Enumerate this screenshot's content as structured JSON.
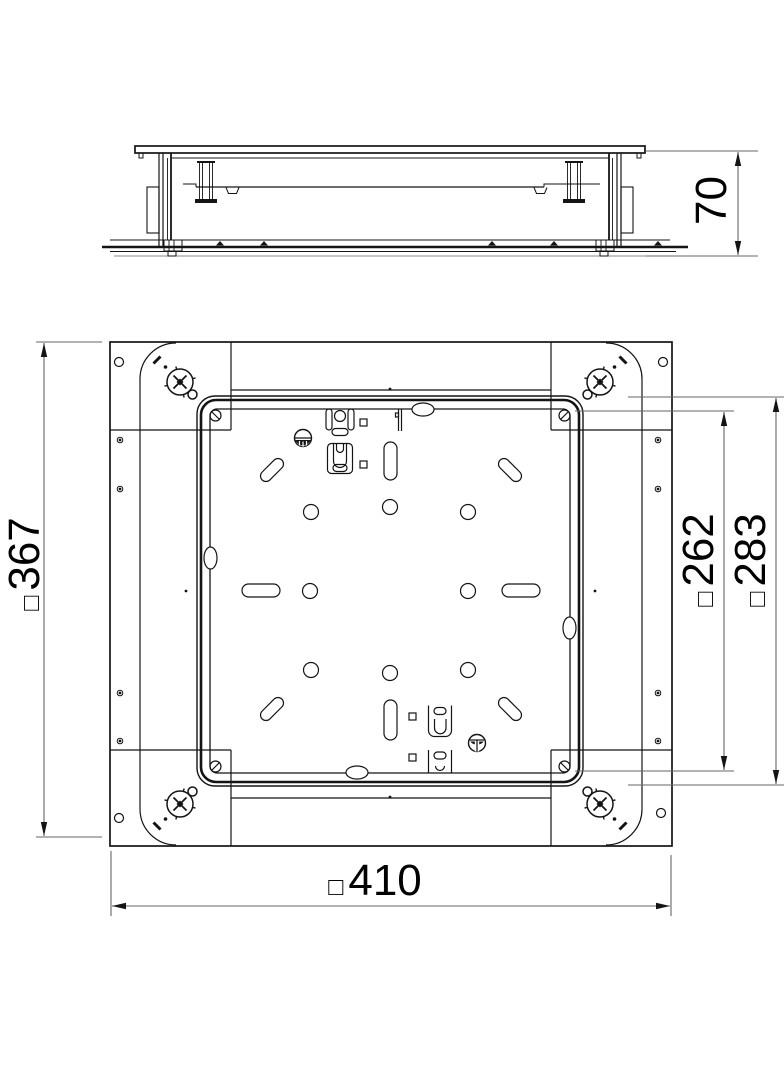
{
  "drawing": {
    "title": "underfloor-box-dimension-drawing",
    "dimensions": {
      "depth": {
        "prefix": "",
        "value": "70"
      },
      "frame_height": {
        "prefix": "□",
        "value": "367"
      },
      "plate": {
        "prefix": "□",
        "value": "262"
      },
      "cassette": {
        "prefix": "□",
        "value": "283"
      },
      "overall": {
        "prefix": "□",
        "value": "410"
      }
    },
    "colors": {
      "line": "#141414",
      "dim_line": "#666666",
      "background": "#ffffff"
    }
  }
}
